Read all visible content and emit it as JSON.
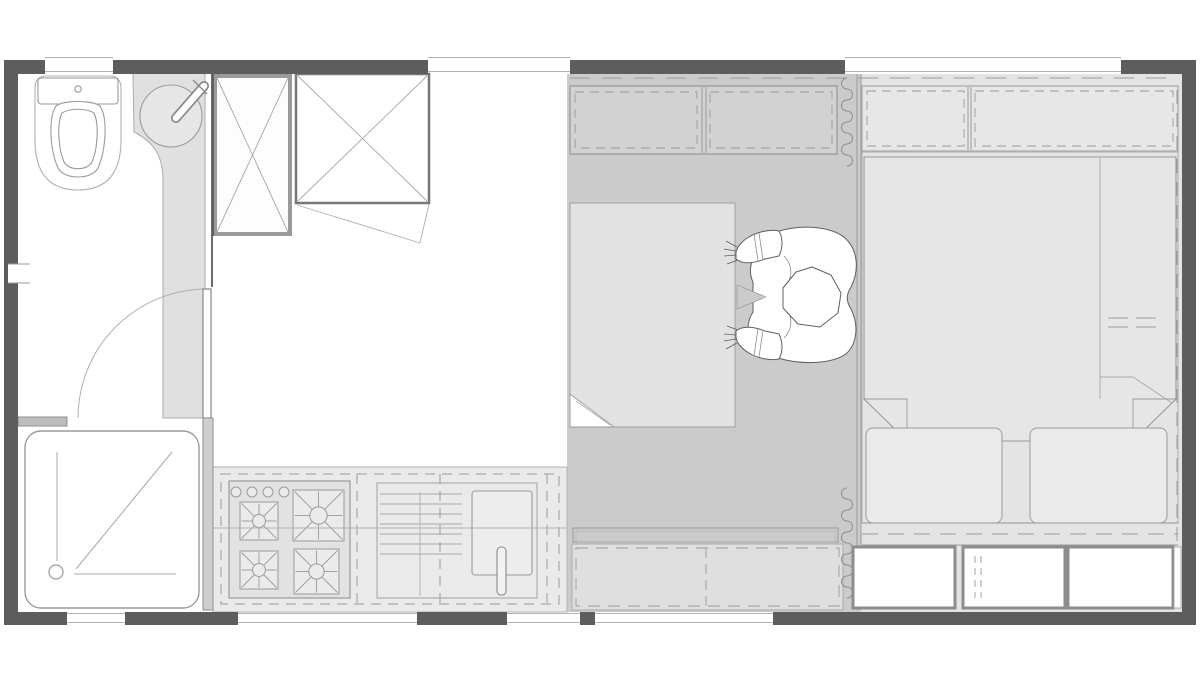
{
  "app": {
    "type": "architectural-floor-plan",
    "view": "top-down plan of a small studio / tiny-house unit",
    "canvas_w": 1200,
    "canvas_h": 679
  },
  "palette": {
    "wall": "#5d5d5d",
    "line": "#9a9a9a",
    "line_light": "#b3b3b3",
    "line_dark": "#6b6b6b",
    "floor_middle": "#cbcbcb",
    "floor_right": "#e4e4e4",
    "cabinet_middle": "#d2d2d2",
    "cabinet_right": "#e7e7e7",
    "counter": "#eaeaea",
    "stove": "#e2e2e2",
    "burner": "#ebebeb",
    "desk": "#e2e2e2",
    "bench": "#dfdfdf",
    "duvet": "#e6e6e6",
    "pillow": "#eaeaea",
    "vanity": "#e0e0e0",
    "drawer": "#ffffff",
    "white": "#ffffff"
  },
  "walls": [
    [
      4,
      60,
      14,
      565
    ],
    [
      4,
      60,
      41,
      14
    ],
    [
      113,
      60,
      315,
      14
    ],
    [
      570,
      60,
      275,
      14
    ],
    [
      1121,
      60,
      75,
      14
    ],
    [
      1182,
      60,
      14,
      565
    ],
    [
      4,
      612,
      63,
      13
    ],
    [
      125,
      612,
      113,
      13
    ],
    [
      417,
      612,
      90,
      13
    ],
    [
      580,
      612,
      15,
      13
    ],
    [
      773,
      612,
      423,
      13
    ]
  ],
  "windows": {
    "top_y": [
      57.5,
      71.5
    ],
    "bottom_y": [
      613.5,
      622.5
    ],
    "top": [
      [
        45,
        113
      ],
      [
        428,
        570
      ],
      [
        845,
        1121
      ]
    ],
    "bottom": [
      [
        67,
        125
      ],
      [
        238,
        417
      ],
      [
        507,
        580
      ],
      [
        595,
        773
      ]
    ]
  },
  "niche": {
    "x": 8,
    "y": 264,
    "w": 22,
    "h": 19
  },
  "curtain": {
    "x": 847,
    "radius": 5.5,
    "segments": [
      [
        78,
        172
      ],
      [
        488,
        608
      ]
    ]
  },
  "kitchen": {
    "burners": [
      [
        240,
        502,
        38
      ],
      [
        293,
        490,
        51
      ],
      [
        240,
        551,
        38
      ],
      [
        294,
        549,
        45
      ]
    ],
    "knobs": {
      "cy": 492,
      "r": 5,
      "cx": [
        236,
        252,
        268,
        284
      ]
    }
  },
  "rooms": [
    "bathroom",
    "kitchen-dining",
    "workspace",
    "sleeping-area"
  ],
  "fixtures": [
    "toilet",
    "washbasin-vanity",
    "basin-faucet",
    "shower-tray",
    "shower-drain",
    "bathroom-door",
    "wardrobe-small",
    "wardrobe-large",
    "stove-4-burner",
    "drainboard",
    "kitchen-sink",
    "kitchen-faucet",
    "overhead-cabinets",
    "desk",
    "person-at-desk",
    "storage-bench",
    "curtain-divider",
    "double-bed",
    "duvet",
    "pillow-left",
    "pillow-right",
    "under-bed-drawers",
    "vent-grille"
  ]
}
